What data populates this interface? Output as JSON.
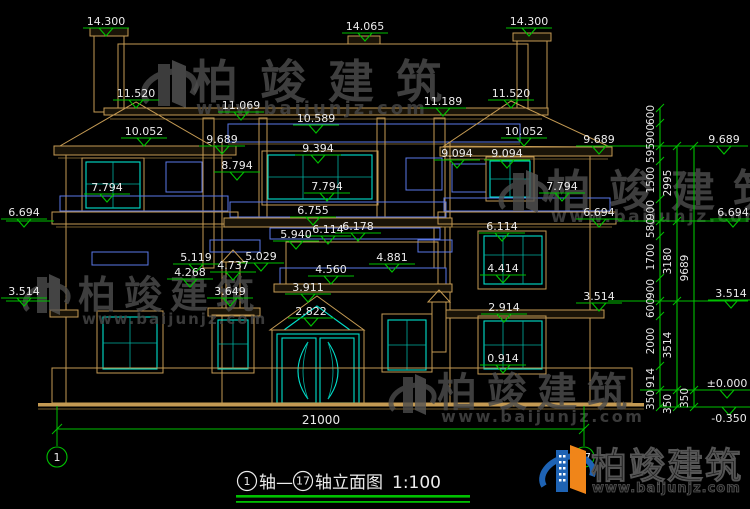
{
  "drawing_title": {
    "axis_start": "1",
    "axis_join": "轴—",
    "axis_end": "17",
    "name": "轴立面图",
    "scale": "1:100"
  },
  "axes": {
    "left_bubble": "1",
    "right_bubble": "17"
  },
  "bottom_dim": {
    "value": "21000"
  },
  "watermark": {
    "name": "柏竣建筑",
    "url": "www.baijunjz.com"
  },
  "logo": {
    "name": "柏竣建筑",
    "url": "www.baijunjz.com"
  },
  "colors": {
    "background": "#000000",
    "cad_line_tan": "#c49a53",
    "cad_green": "#00c000",
    "window_cyan": "#00e0cc",
    "ornament_blue": "#5a78e8",
    "text_white": "#ececec",
    "watermark_gray": "#4c4c4c",
    "logo_blue": "#1e63b4",
    "logo_orange": "#f08519"
  },
  "elevation_markers": [
    {
      "value": "14.300",
      "x": 106,
      "y": 28
    },
    {
      "value": "14.065",
      "x": 365,
      "y": 33
    },
    {
      "value": "14.300",
      "x": 529,
      "y": 28
    },
    {
      "value": "11.520",
      "x": 136,
      "y": 100
    },
    {
      "value": "11.069",
      "x": 241,
      "y": 112
    },
    {
      "value": "10.589",
      "x": 316,
      "y": 125
    },
    {
      "value": "11.189",
      "x": 443,
      "y": 108
    },
    {
      "value": "11.520",
      "x": 511,
      "y": 100
    },
    {
      "value": "10.052",
      "x": 144,
      "y": 138
    },
    {
      "value": "9.689",
      "x": 222,
      "y": 146
    },
    {
      "value": "9.394",
      "x": 318,
      "y": 155
    },
    {
      "value": "9.094",
      "x": 457,
      "y": 160
    },
    {
      "value": "9.094",
      "x": 507,
      "y": 160
    },
    {
      "value": "10.052",
      "x": 524,
      "y": 138
    },
    {
      "value": "9.689",
      "x": 599,
      "y": 146
    },
    {
      "value": "9.689",
      "x": 724,
      "y": 146
    },
    {
      "value": "8.794",
      "x": 237,
      "y": 172
    },
    {
      "value": "7.794",
      "x": 107,
      "y": 194
    },
    {
      "value": "7.794",
      "x": 327,
      "y": 193
    },
    {
      "value": "7.794",
      "x": 562,
      "y": 193
    },
    {
      "value": "6.694",
      "x": 24,
      "y": 219
    },
    {
      "value": "6.755",
      "x": 313,
      "y": 217
    },
    {
      "value": "6.114",
      "x": 328,
      "y": 236
    },
    {
      "value": "6.178",
      "x": 358,
      "y": 233
    },
    {
      "value": "5.940",
      "x": 296,
      "y": 241
    },
    {
      "value": "6.694",
      "x": 599,
      "y": 219
    },
    {
      "value": "6.694",
      "x": 733,
      "y": 219
    },
    {
      "value": "6.114",
      "x": 502,
      "y": 233
    },
    {
      "value": "5.119",
      "x": 196,
      "y": 264
    },
    {
      "value": "5.029",
      "x": 261,
      "y": 263
    },
    {
      "value": "4.737",
      "x": 233,
      "y": 272
    },
    {
      "value": "4.268",
      "x": 190,
      "y": 279
    },
    {
      "value": "3.649",
      "x": 230,
      "y": 298
    },
    {
      "value": "4.560",
      "x": 331,
      "y": 276
    },
    {
      "value": "3.911",
      "x": 308,
      "y": 294
    },
    {
      "value": "4.881",
      "x": 392,
      "y": 264
    },
    {
      "value": "4.414",
      "x": 503,
      "y": 275
    },
    {
      "value": "3.514",
      "x": 24,
      "y": 298
    },
    {
      "value": "3.514",
      "x": 599,
      "y": 303
    },
    {
      "value": "3.514",
      "x": 731,
      "y": 300
    },
    {
      "value": "2.822",
      "x": 311,
      "y": 318
    },
    {
      "value": "2.914",
      "x": 504,
      "y": 314
    },
    {
      "value": "0.914",
      "x": 503,
      "y": 365
    },
    {
      "value": "±0.000",
      "x": 727,
      "y": 390
    },
    {
      "value": "-0.350",
      "x": 729,
      "y": 407,
      "below": true
    }
  ],
  "dim_right": {
    "columns": [
      {
        "x": 660,
        "ticks": [
          108,
          123,
          146,
          161,
          199,
          221,
          236,
          278,
          301,
          316,
          366,
          390,
          407
        ],
        "labels": [
          {
            "v": "600",
            "y": 115
          },
          {
            "v": "900",
            "y": 134
          },
          {
            "v": "595",
            "y": 153
          },
          {
            "v": "1500",
            "y": 180
          },
          {
            "v": "900",
            "y": 210
          },
          {
            "v": "580",
            "y": 228
          },
          {
            "v": "1700",
            "y": 257
          },
          {
            "v": "900",
            "y": 289
          },
          {
            "v": "600",
            "y": 308
          },
          {
            "v": "2000",
            "y": 341
          },
          {
            "v": "914",
            "y": 378
          },
          {
            "v": "350",
            "y": 400
          }
        ]
      },
      {
        "x": 677,
        "ticks": [
          146,
          221,
          301,
          390,
          407
        ],
        "labels": [
          {
            "v": "2995",
            "y": 183
          },
          {
            "v": "3180",
            "y": 261
          },
          {
            "v": "3514",
            "y": 345
          },
          {
            "v": "350",
            "y": 404
          }
        ]
      },
      {
        "x": 694,
        "ticks": [
          146,
          390,
          407
        ],
        "labels": [
          {
            "v": "9689",
            "y": 268
          },
          {
            "v": "350",
            "y": 398
          }
        ]
      }
    ]
  }
}
